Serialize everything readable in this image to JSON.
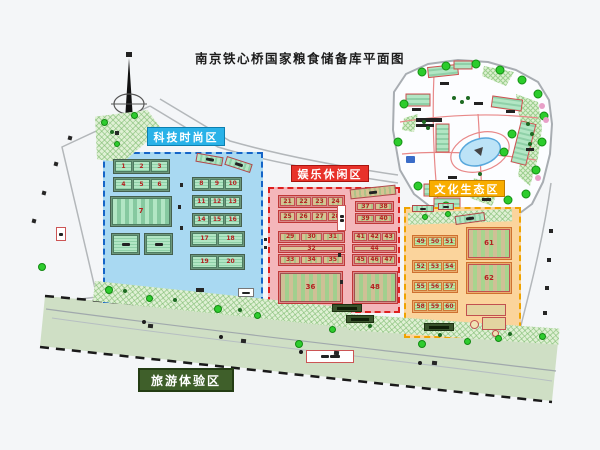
{
  "title": "南京铁心桥国家粮食储备库平面图",
  "zones": {
    "tech": {
      "label": "科技时尚区",
      "rows": [
        [
          "1",
          "2",
          "3"
        ],
        [
          "4",
          "5",
          "6"
        ]
      ],
      "big": "7",
      "right_rows": [
        [
          "8",
          "9",
          "10"
        ],
        [
          "11",
          "12",
          "13"
        ],
        [
          "14",
          "15",
          "16"
        ],
        [
          "17",
          "18"
        ],
        [
          "19",
          "20"
        ]
      ]
    },
    "fun": {
      "label": "娱乐休闲区",
      "tl_rows": [
        [
          "21",
          "22",
          "23",
          "24"
        ],
        [
          "25",
          "26",
          "27",
          "28"
        ]
      ],
      "bl_top": [
        "29",
        "30",
        "31"
      ],
      "bl_mid": "32",
      "bl_bottom": [
        "33",
        "34",
        "35"
      ],
      "big_left": "36",
      "tr_rows": [
        [
          "37",
          "38"
        ],
        [
          "39",
          "40"
        ]
      ],
      "br_top": [
        "41",
        "42",
        "43"
      ],
      "br_mid": "44",
      "br_bottom": [
        "45",
        "46",
        "47"
      ],
      "big_right": "48"
    },
    "culture": {
      "label": "文化生态区",
      "rows": [
        [
          "49",
          "50",
          "51"
        ],
        [
          "52",
          "53",
          "54"
        ],
        [
          "55",
          "56",
          "57"
        ],
        [
          "58",
          "59",
          "60"
        ]
      ],
      "big_top": "61",
      "big_bottom": "62"
    },
    "tour": {
      "label": "旅游体验区"
    }
  },
  "colors": {
    "tech_accent": "#29b2e8",
    "fun_accent": "#e8322a",
    "culture_accent": "#f9ad00",
    "tour_accent": "#3f5f2a",
    "building_number": "#b42020"
  }
}
